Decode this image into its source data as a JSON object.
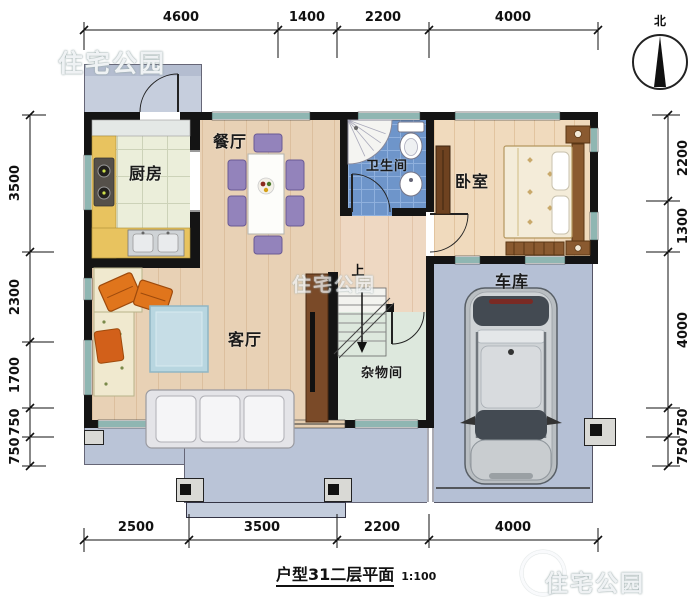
{
  "watermark": {
    "text": "住宅公园"
  },
  "compass": {
    "north_label": "北"
  },
  "dimensions": {
    "top": [
      "4600",
      "1400",
      "2200",
      "4000"
    ],
    "bottom": [
      "2500",
      "3500",
      "2200",
      "4000"
    ],
    "left": [
      "3500",
      "2300",
      "1700",
      "750",
      "750"
    ],
    "right": [
      "2200",
      "1300",
      "4000",
      "750",
      "750"
    ]
  },
  "rooms": {
    "kitchen": {
      "label": "厨房"
    },
    "dining": {
      "label": "餐厅"
    },
    "bathroom": {
      "label": "卫生间"
    },
    "bedroom": {
      "label": "卧室"
    },
    "living": {
      "label": "客厅"
    },
    "storage": {
      "label": "杂物间"
    },
    "garage": {
      "label": "车库"
    }
  },
  "stairs": {
    "direction_label": "上"
  },
  "caption": {
    "text": "户型31二层平面",
    "scale": "1:100"
  },
  "colors": {
    "wall": "#141414",
    "outdoor_concrete": "#b9c3d6",
    "wood_floor": "#e8d1b5",
    "bath_tile": "#6e95ca",
    "window_frame": "#1f6e66",
    "counter_yellow": "#e8c35f",
    "chair_purple": "#9383bb",
    "sofa_orange": "#e0751c"
  }
}
